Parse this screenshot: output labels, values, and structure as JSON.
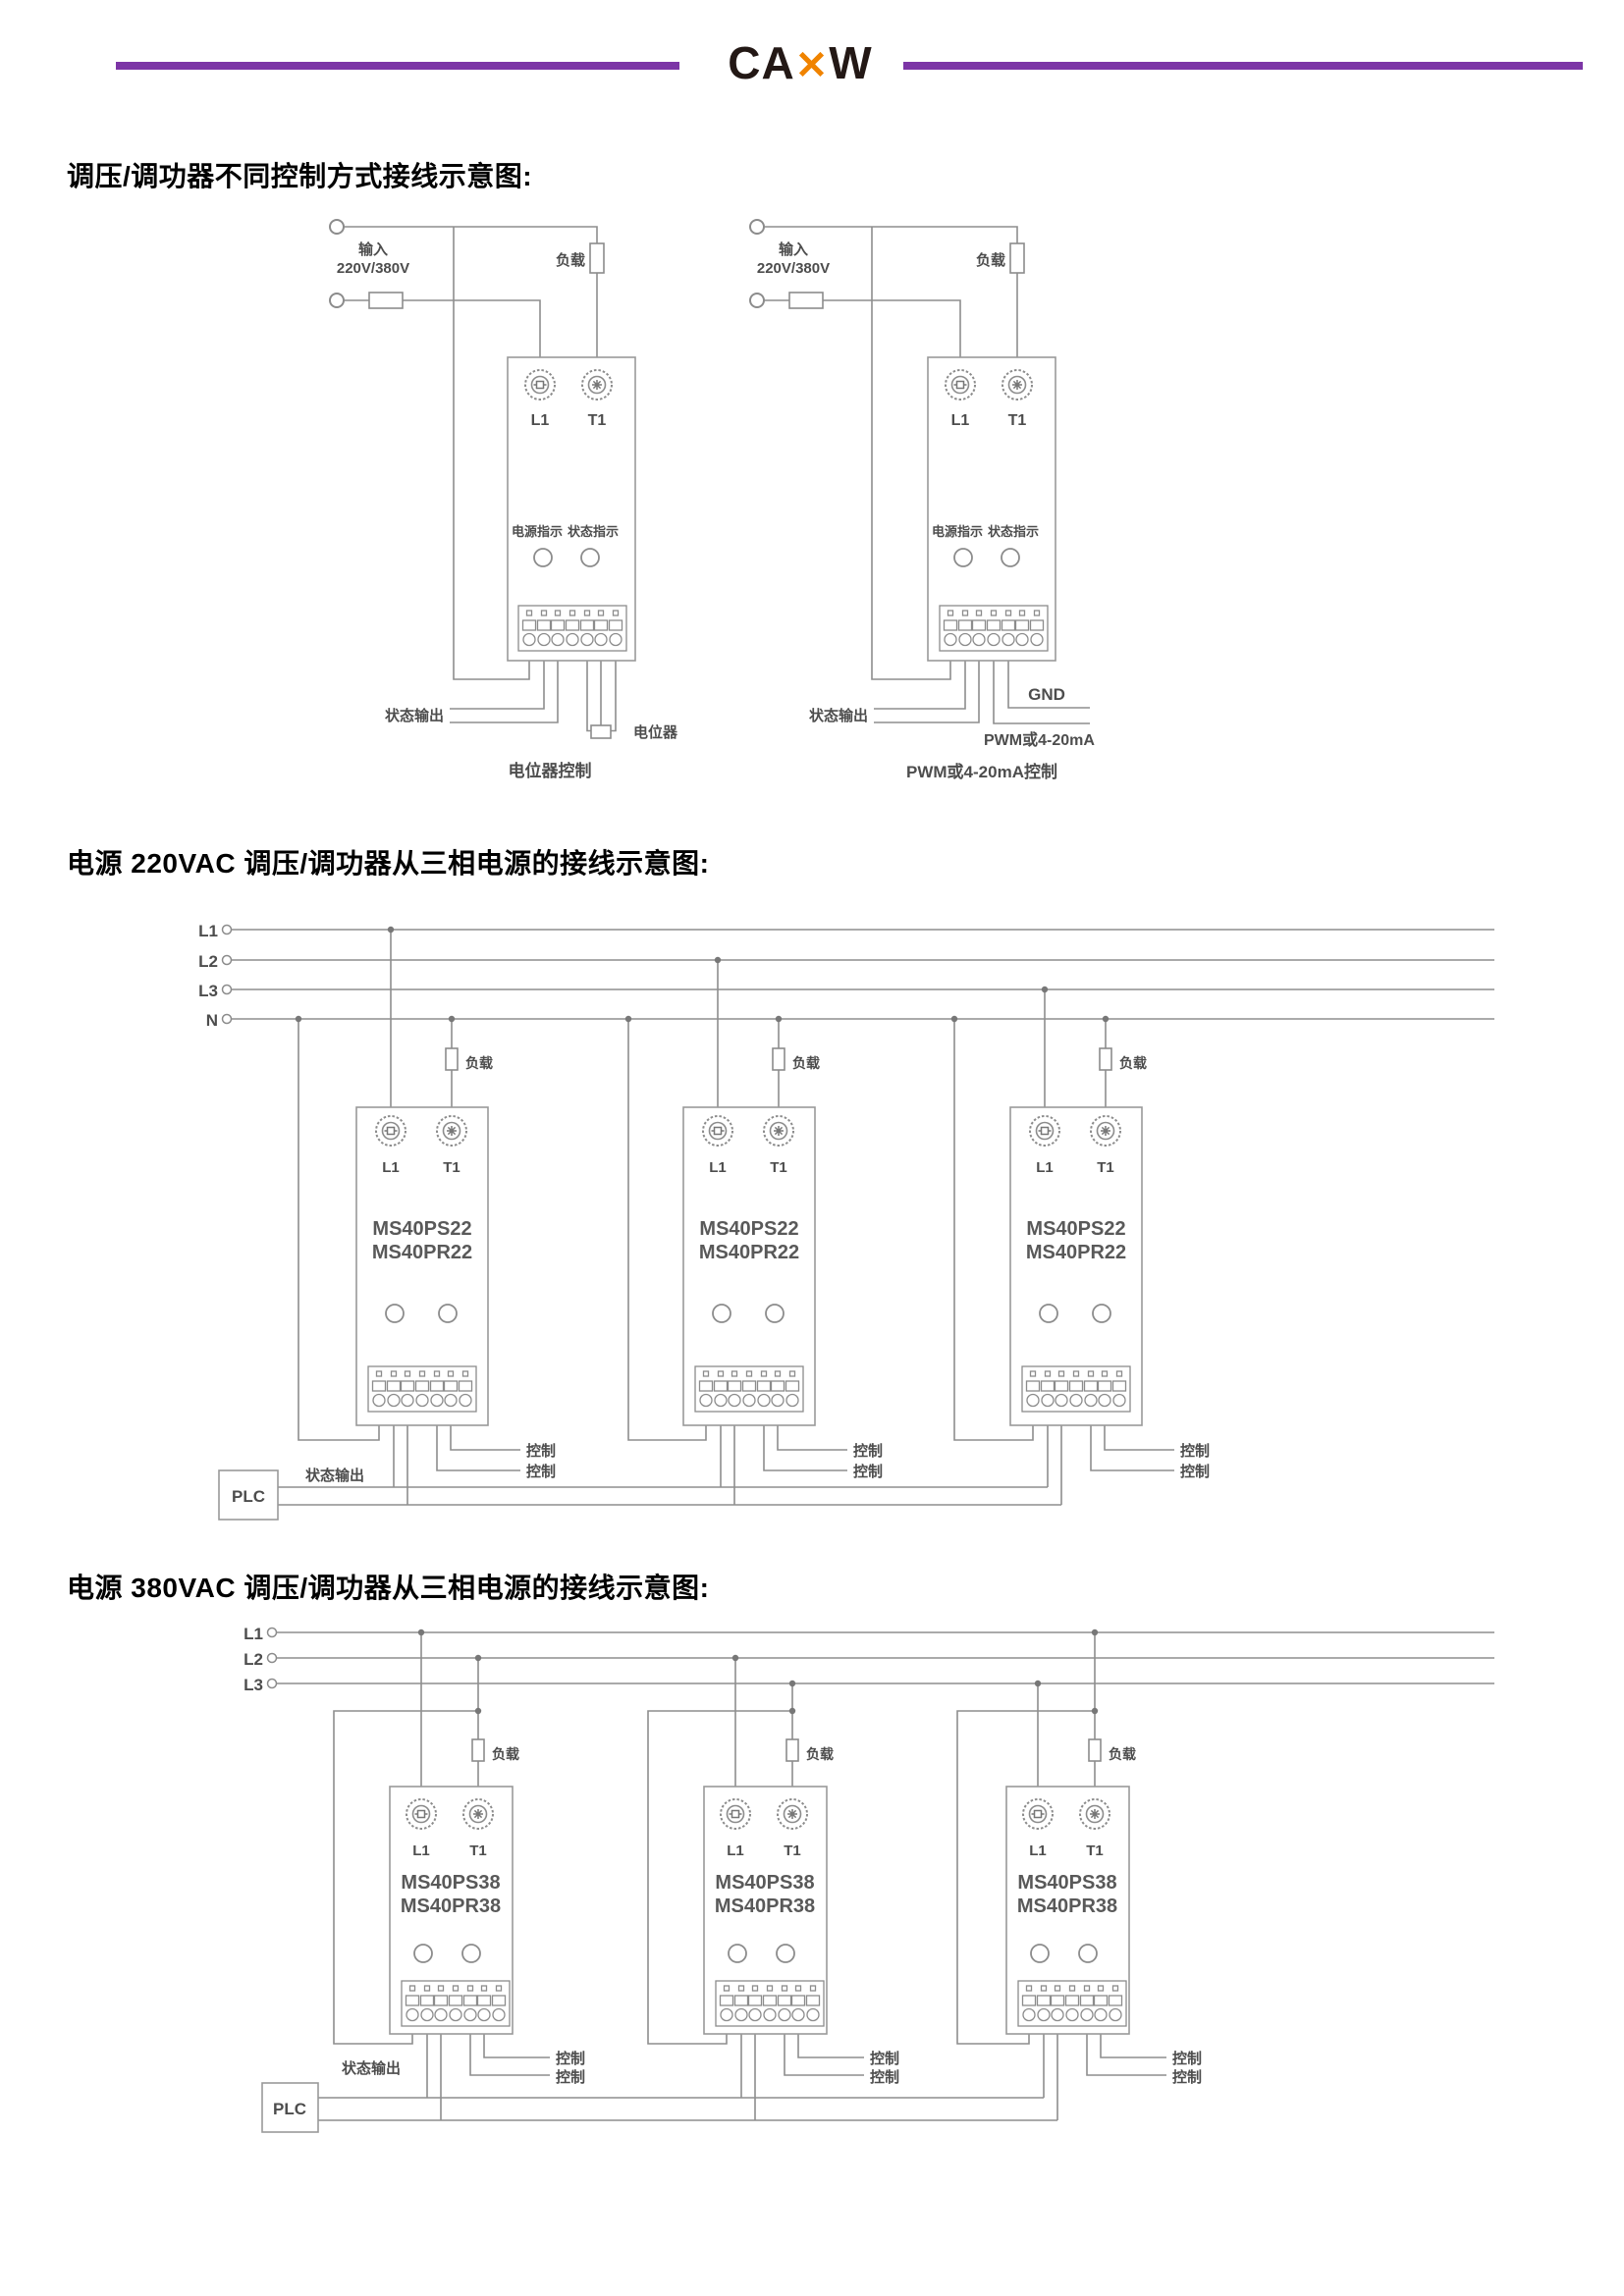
{
  "header": {
    "brand_pre": "CA",
    "brand_x": "✕",
    "brand_post": "W"
  },
  "titles": {
    "s1": "调压/调功器不同控制方式接线示意图:",
    "s2": "电源 220VAC 调压/调功器从三相电源的接线示意图:",
    "s3": "电源 380VAC 调压/调功器从三相电源的接线示意图:"
  },
  "labels": {
    "input_1": "输入",
    "input_2": "220V/380V",
    "load": "负载",
    "l1": "L1",
    "t1": "T1",
    "power_led": "电源指示",
    "status_led": "状态指示",
    "status_out": "状态输出",
    "pot": "电位器",
    "pot_caption": "电位器控制",
    "gnd": "GND",
    "pwm": "PWM或4-20mA",
    "pwm_caption": "PWM或4-20mA控制",
    "control": "控制",
    "plc": "PLC"
  },
  "bus": {
    "s2": [
      "L1",
      "L2",
      "L3",
      "N"
    ],
    "s3": [
      "L1",
      "L2",
      "L3"
    ]
  },
  "models": {
    "m220_1": "MS40PS22",
    "m220_2": "MS40PR22",
    "m380_1": "MS40PS38",
    "m380_2": "MS40PR38"
  },
  "colors": {
    "accent": "#7c35a6",
    "logo_x": "#f08300",
    "wire": "#8e8e8e",
    "diagram_text": "#4d4d4d"
  }
}
